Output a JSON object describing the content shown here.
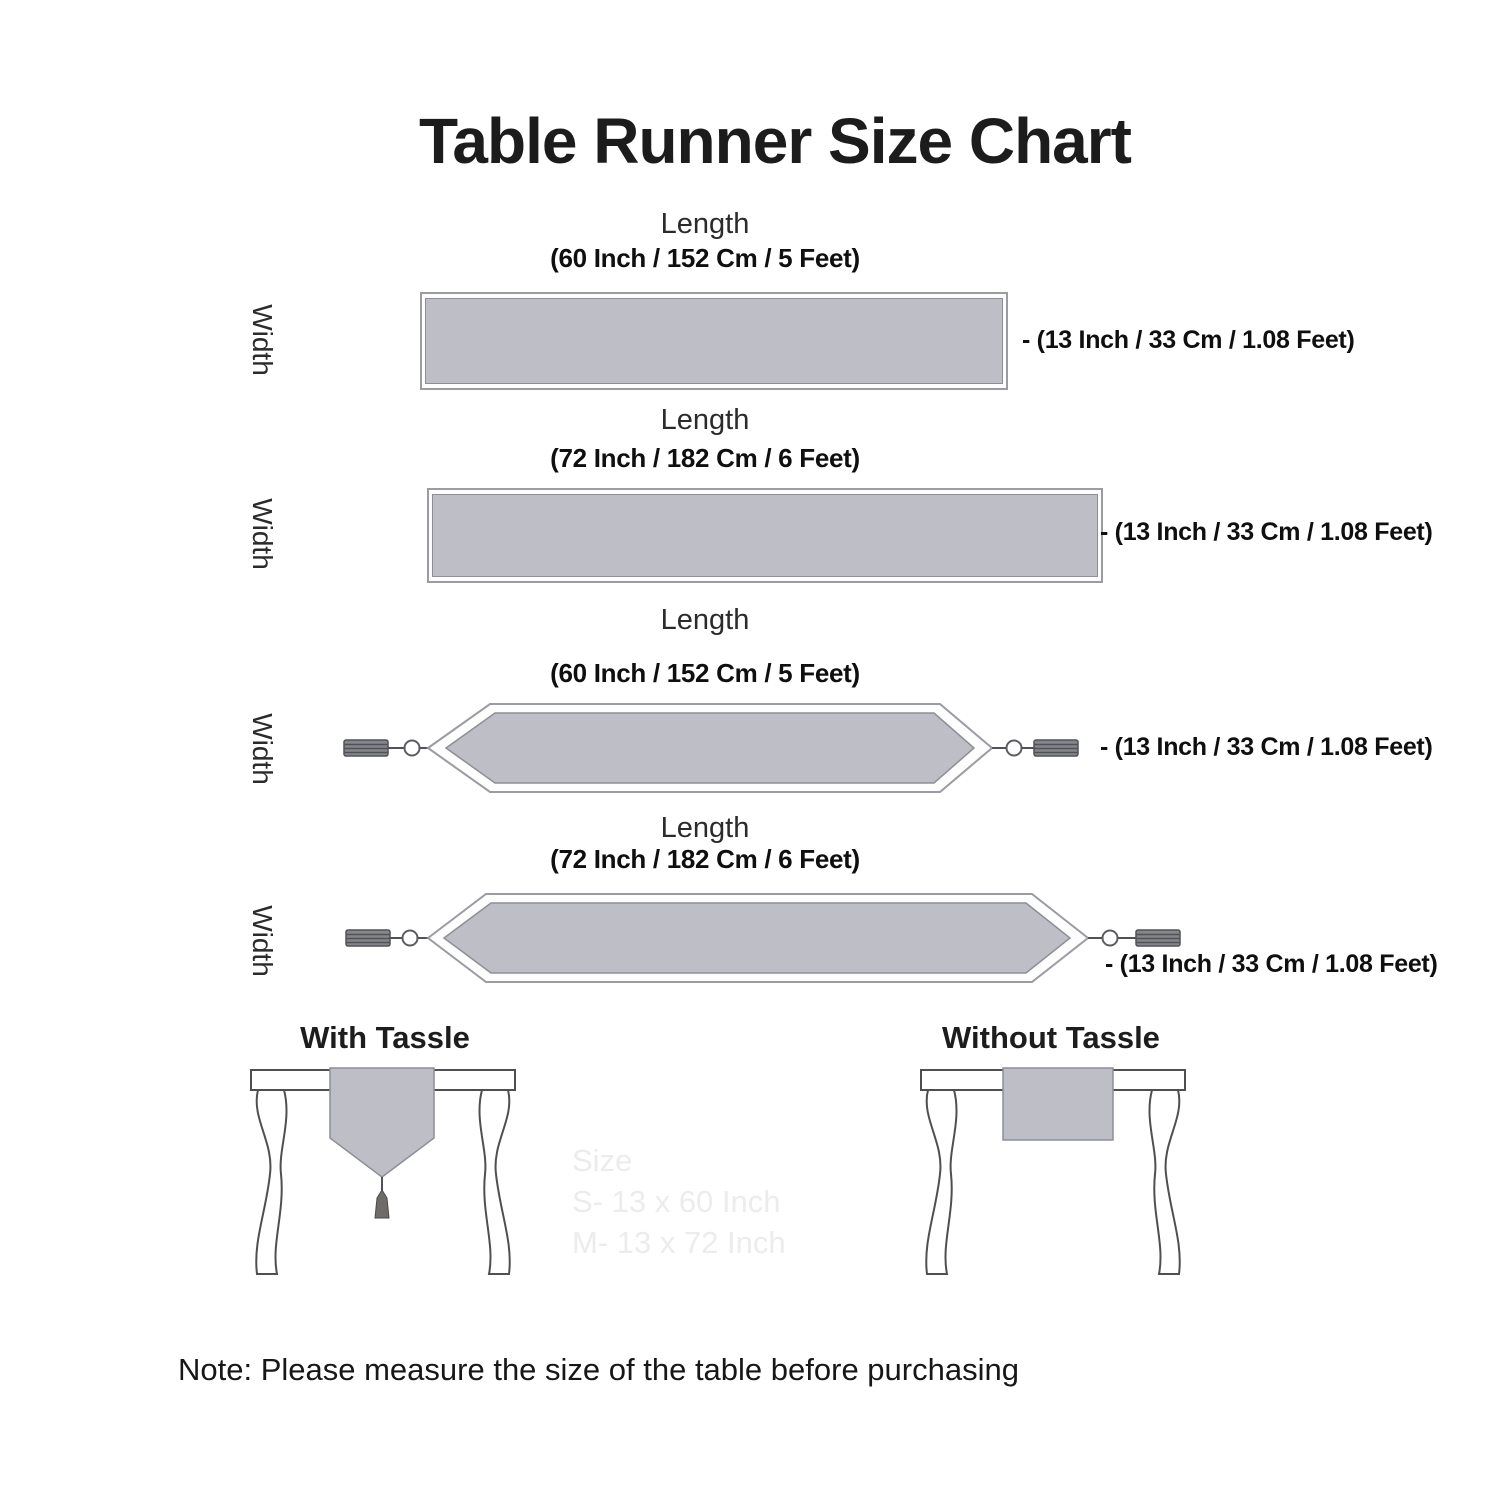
{
  "title": "Table Runner Size Chart",
  "runners": [
    {
      "type": "rectangle",
      "length_label": "Length",
      "length_size": "(60 Inch / 152 Cm / 5 Feet)",
      "width_label": "Width",
      "width_size": "- (13 Inch / 33 Cm / 1.08 Feet)"
    },
    {
      "type": "rectangle",
      "length_label": "Length",
      "length_size": "(72 Inch / 182 Cm / 6 Feet)",
      "width_label": "Width",
      "width_size": "- (13 Inch / 33 Cm / 1.08 Feet)"
    },
    {
      "type": "pointed-with-tassels",
      "length_label": "Length",
      "length_size": "(60 Inch / 152 Cm / 5 Feet)",
      "width_label": "Width",
      "width_size": "- (13 Inch / 33 Cm / 1.08 Feet)"
    },
    {
      "type": "pointed-with-tassels",
      "length_label": "Length",
      "length_size": "(72 Inch / 182 Cm / 6 Feet)",
      "width_label": "Width",
      "width_size": "- (13 Inch / 33 Cm / 1.08 Feet)"
    }
  ],
  "style_examples": [
    {
      "label": "With Tassle"
    },
    {
      "label": "Without Tassle"
    }
  ],
  "watermark": {
    "line1": "Size",
    "line2": "S- 13 x 60 Inch",
    "line3": "M- 13 x 72 Inch"
  },
  "note": "Note: Please measure the size of the table before purchasing",
  "colors": {
    "runner_fill": "#bdbec6",
    "runner_border": "#8e8f96",
    "outline": "#9b9ca2",
    "tassel_fill": "#85868b",
    "tassel_stripe": "#515256",
    "table_line": "#4f4f51",
    "watermark": "#ececec"
  }
}
